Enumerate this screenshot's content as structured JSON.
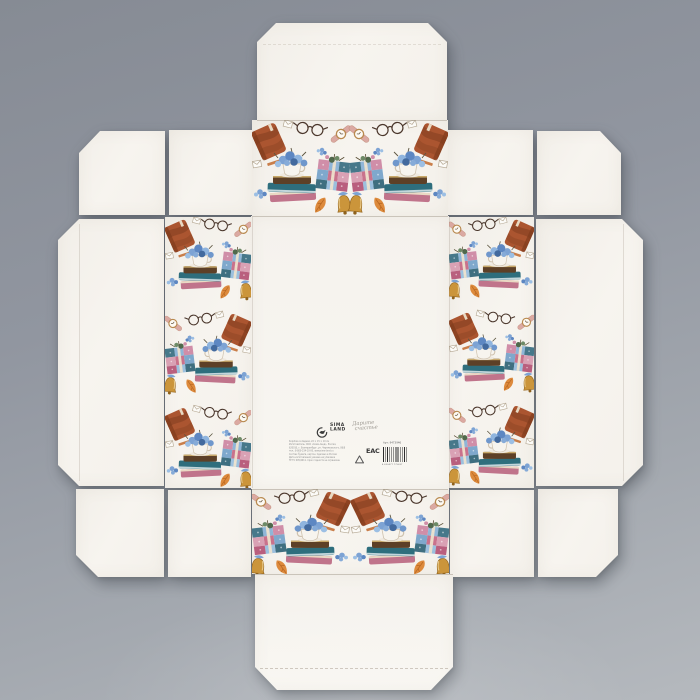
{
  "photo": {
    "subject": "unfolded folding gift box die-cut on gray studio background",
    "background_color_top": "#8b9097",
    "background_color_bottom": "#b5b9be",
    "cardboard_color": "#f6f3ee"
  },
  "brand": {
    "logo_word1": "SIMA",
    "logo_word2": "LAND",
    "tagline_word1": "Дарите",
    "tagline_word2": "счастье"
  },
  "print_info": {
    "art_number": "Арт: 9473946",
    "certification_mark": "ЕАС",
    "barcode_digits": "4 690477 775437",
    "fine_print_lines": [
      "Коробка складная, 22 × 15 × 10 см",
      "Изготовитель: ООО «Сима-ленд», Россия,",
      "620010, г. Екатеринбург, ул. Черняховского, 86/8",
      "тел.: 8-800-234-10-00, www.sima-land.ru",
      "Состав: бумага, картон. Сделано в России",
      "Дата изготовления указана на упаковке",
      "ТР ТС 005/2011. Срок годности не ограничен"
    ]
  },
  "pattern": {
    "description": "watercolor book-and-flower motifs printed on white panels",
    "motifs": [
      "brown-notebook",
      "book-stack-with-teacup",
      "blue-hydrangea-flowers",
      "floral-gift-box",
      "round-glasses",
      "wristwatch",
      "gold-bell",
      "autumn-leaf",
      "envelope",
      "pencil"
    ],
    "colors": {
      "book_brown": "#ab5530",
      "flower_blue": "#5d87c2",
      "patch_pink": "#d08ea8",
      "patch_blue": "#8fb6d8",
      "teal": "#2e6e7d",
      "bell_gold": "#cb953b"
    }
  }
}
